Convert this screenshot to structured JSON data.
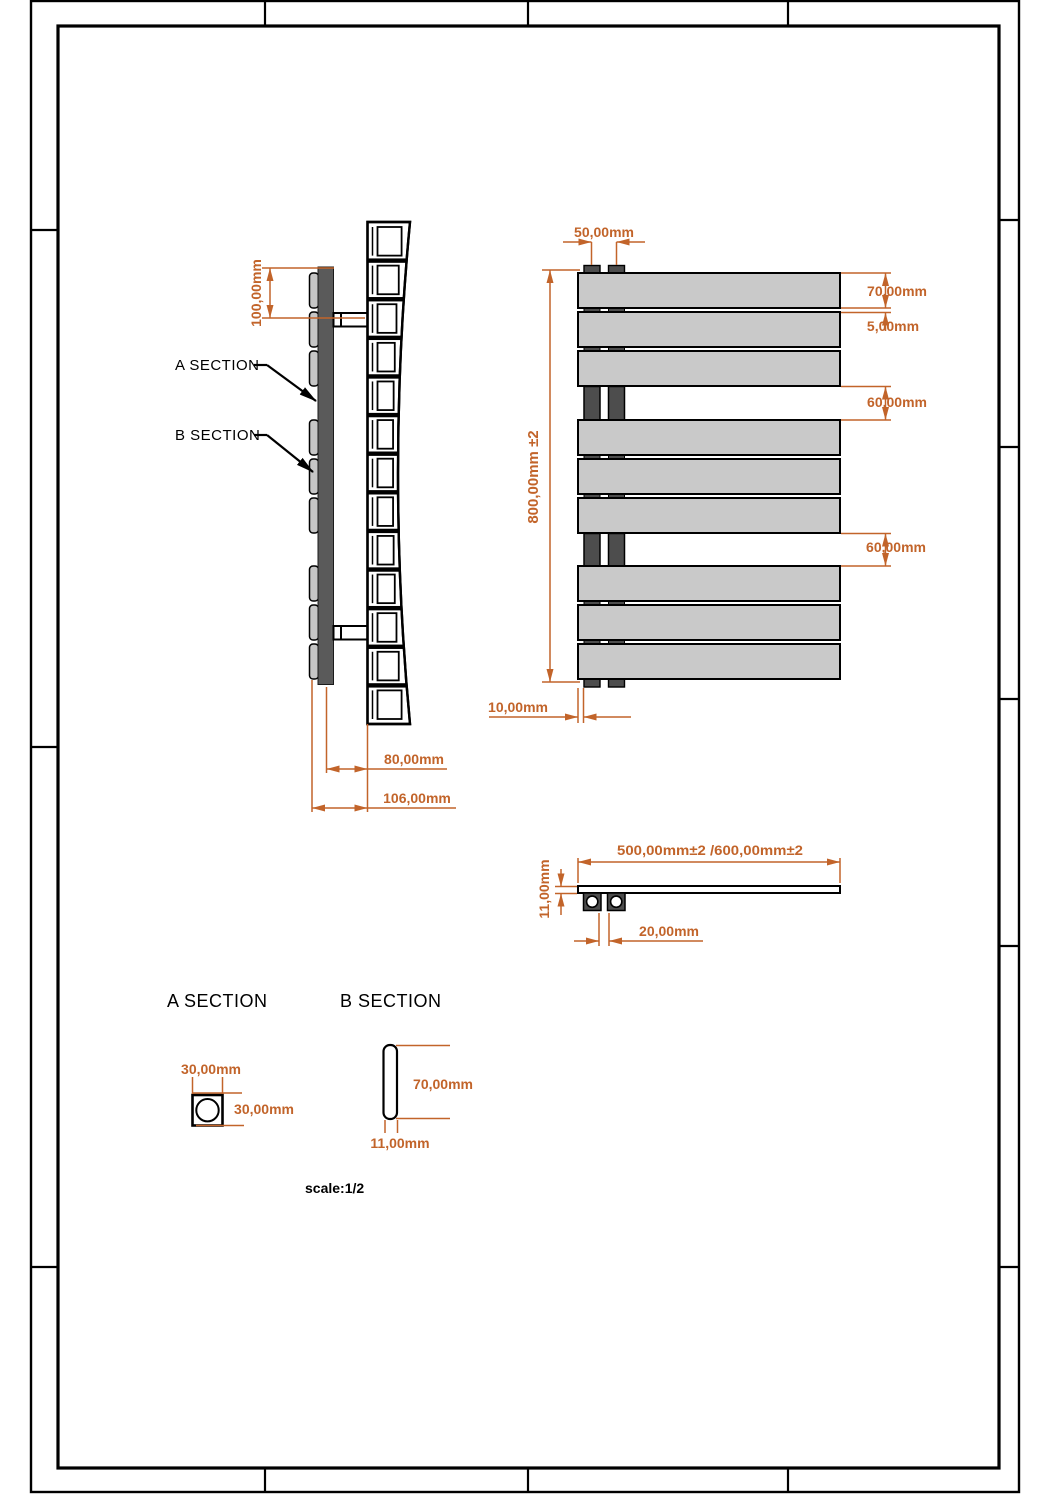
{
  "colors": {
    "dimension_accent": "#c2642a",
    "panel_fill": "#c9c9c9",
    "tube_fill": "#4d4d4d",
    "collector_fill": "#5a5a5a",
    "tab_fill": "#c6c6c6",
    "outline": "#000000"
  },
  "side_view": {
    "label_a": "A SECTION",
    "label_b": "B SECTION",
    "dim_bracket_offset": "100,00mm",
    "dim_depth": "80,00mm",
    "dim_overall_depth": "106,00mm"
  },
  "front_view": {
    "dim_tube_spacing": "50,00mm",
    "dim_panel_height": "70,00mm",
    "dim_panel_gap": "5,00mm",
    "dim_group_gap_top": "60,00mm",
    "dim_group_gap_bottom": "60,00mm",
    "dim_overall_height": "800,00mm ±2",
    "dim_tube_inset": "10,00mm"
  },
  "top_view": {
    "dim_width": "500,00mm±2 /600,00mm±2",
    "dim_thickness": "11,00mm",
    "dim_tube_gap": "20,00mm"
  },
  "details": {
    "heading_a": "A SECTION",
    "heading_b": "B SECTION",
    "a_width": "30,00mm",
    "a_height": "30,00mm",
    "b_height": "70,00mm",
    "b_thickness": "11,00mm"
  },
  "notes": {
    "scale": "scale:1/2"
  }
}
